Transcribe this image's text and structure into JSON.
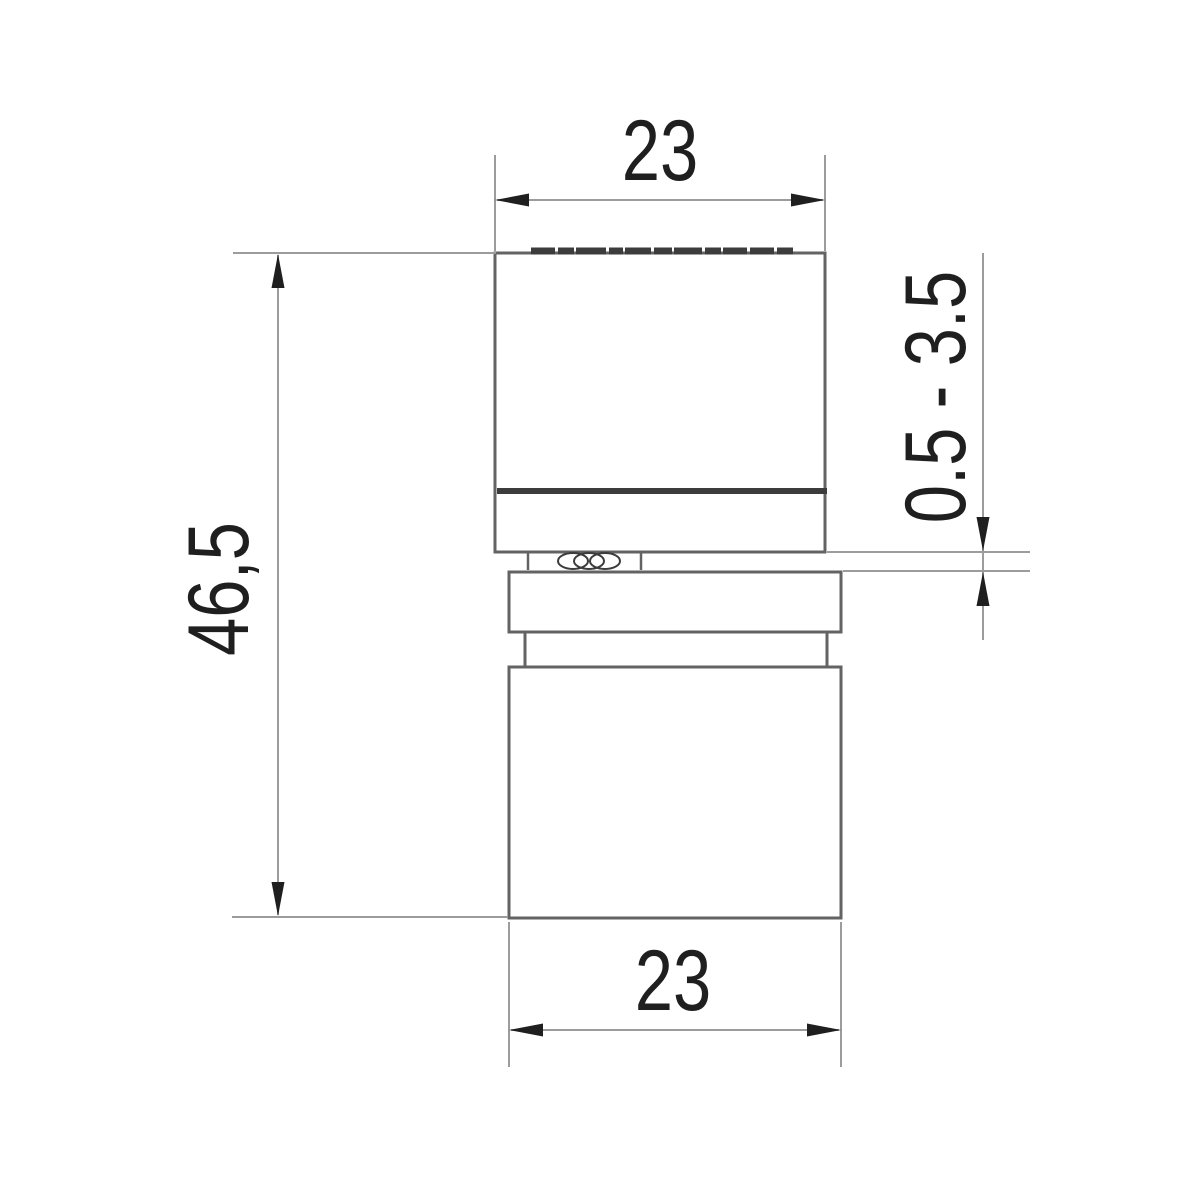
{
  "dimensions": {
    "top_width": "23",
    "overall_height": "46,5",
    "gap_range": "0.5 - 3.5",
    "bottom_width": "23"
  },
  "colors": {
    "outline": "#636363",
    "dimension_line": "#9c9c9c",
    "heavy_line": "#3c3c3c",
    "ink": "#1f1f1f",
    "background": "#ffffff"
  }
}
